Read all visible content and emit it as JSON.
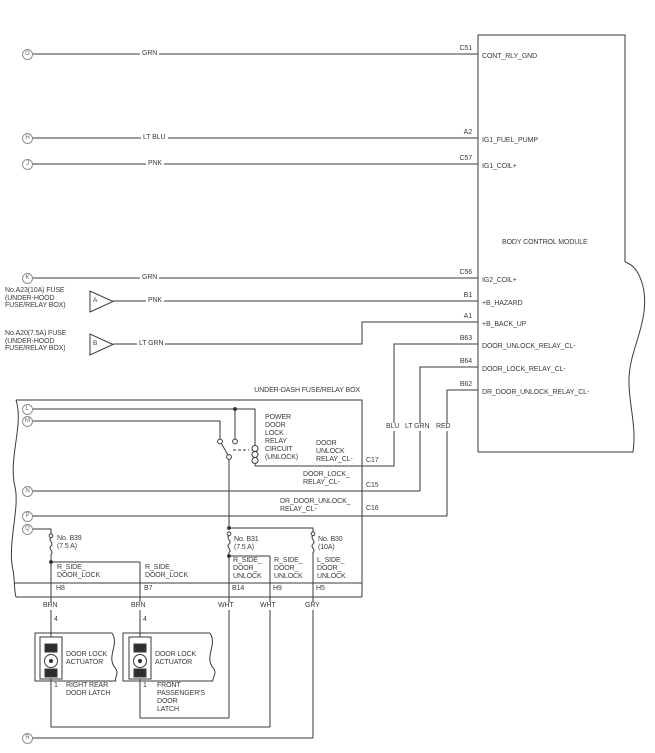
{
  "bcm": {
    "title": "BODY CONTROL MODULE",
    "pins": [
      {
        "pin": "C51",
        "signal": "CONT_RLY_GND"
      },
      {
        "pin": "A2",
        "signal": "IG1_FUEL_PUMP"
      },
      {
        "pin": "C57",
        "signal": "IG1_COIL+"
      },
      {
        "pin": "C56",
        "signal": "IG2_COIL+"
      },
      {
        "pin": "B1",
        "signal": "+B_HAZARD"
      },
      {
        "pin": "A1",
        "signal": "+B_BACK_UP"
      },
      {
        "pin": "B63",
        "signal": "DOOR_UNLOCK_RELAY_CL-"
      },
      {
        "pin": "B64",
        "signal": "DOOR_LOCK_RELAY_CL-"
      },
      {
        "pin": "B62",
        "signal": "DR_DOOR_UNLOCK_RELAY_CL-"
      }
    ]
  },
  "letters": {
    "g": "G",
    "h": "H",
    "j": "J",
    "k": "K",
    "l": "L",
    "m": "M",
    "n": "N",
    "p": "P",
    "q": "Q",
    "r": "R"
  },
  "wire_labels": {
    "grn1": "GRN",
    "ltblu": "LT BLU",
    "pnk1": "PNK",
    "grn2": "GRN",
    "pnk2": "PNK",
    "ltgrn": "LT GRN",
    "blu_v": "BLU",
    "ltgrn_v": "LT GRN",
    "red_v": "RED",
    "brn1": "BRN",
    "brn2": "BRN",
    "wht1": "WHT",
    "wht2": "WHT",
    "gry": "GRY"
  },
  "fuse_a": {
    "lines": [
      "No.A23(10A) FUSE",
      "(UNDER-HOOD",
      "FUSE/RELAY BOX)"
    ],
    "triangle": "A"
  },
  "fuse_b": {
    "lines": [
      "No.A20(7.5A) FUSE",
      "(UNDER-HOOD",
      "FUSE/RELAY BOX)"
    ],
    "triangle": "B"
  },
  "underdash": {
    "title": "UNDER-DASH FUSE/RELAY BOX",
    "relay_lines": [
      "POWER",
      "DOOR",
      "LOCK",
      "RELAY",
      "CIRCUIT",
      "(UNLOCK)"
    ],
    "sig_c17": [
      "DOOR",
      "UNLOCK",
      "RELAY_CL-"
    ],
    "pin_c17": "C17",
    "sig_c15": [
      "DOOR_LOCK_",
      "RELAY_CL-"
    ],
    "pin_c15": "C15",
    "sig_c16": [
      "DR_DOOR_UNLOCK_",
      "RELAY_CL-"
    ],
    "pin_c16": "C16",
    "fuse_b39": [
      "No. B39",
      "(7.5 A)"
    ],
    "fuse_b31": [
      "No. B31",
      "(7.5 A)"
    ],
    "fuse_b30": [
      "No. B30",
      "(10A)"
    ],
    "out1": [
      "R_SIDE_",
      "DOOR_LOCK"
    ],
    "out1_pin": "H8",
    "out2": [
      "R_SIDE_",
      "DOOR_LOCK"
    ],
    "out2_pin": "B7",
    "out3": [
      "R_SIDE_",
      "DOOR_",
      "UNLOCK"
    ],
    "out3_pin": "B14",
    "out4": [
      "R_SIDE_",
      "DOOR_",
      "UNLOCK"
    ],
    "out4_pin": "H9",
    "out5": [
      "L_SIDE_",
      "DOOR_",
      "UNLOCK"
    ],
    "out5_pin": "H5"
  },
  "actuator1": {
    "pin_top": "4",
    "name": [
      "DOOR LOCK",
      "ACTUATOR"
    ],
    "pin_bottom": "1",
    "latch": [
      "RIGHT REAR",
      "DOOR LATCH"
    ]
  },
  "actuator2": {
    "pin_top": "4",
    "name": [
      "DOOR LOCK",
      "ACTUATOR"
    ],
    "pin_bottom": "1",
    "latch": [
      "FRONT",
      "PASSENGER'S",
      "DOOR",
      "LATCH"
    ]
  }
}
